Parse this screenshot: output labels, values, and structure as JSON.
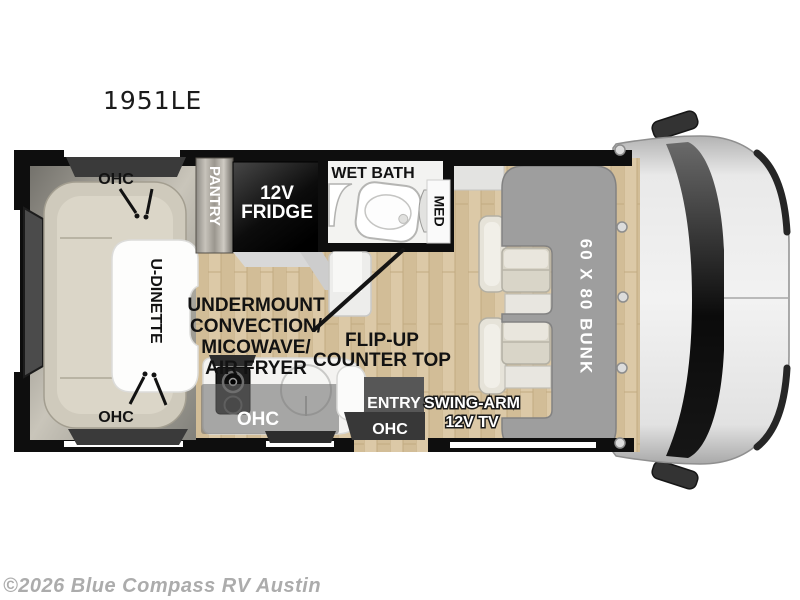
{
  "page": {
    "title": "1951LE",
    "watermark": "©2026 Blue Compass RV Austin"
  },
  "colors": {
    "wall": "#0e0e0e",
    "floor_light": "#dcc9a7",
    "floor_dark": "#d2bd97",
    "slide_gray": "#c9c5ba",
    "seat_cream": "#dbd6c8",
    "bunk_gray": "#9e9e9e",
    "cab_gray": "#ededed",
    "windshield_black": "#0b0b0b",
    "box_entry": "#575757",
    "box_ohc": "#383838",
    "label_light": "#ffffff",
    "label_dark": "#121212",
    "watermark_gray": "#acacac"
  },
  "floorplan": {
    "dinette": {
      "label": "U-DINETTE",
      "ohc_top": "OHC",
      "ohc_bottom": "OHC"
    },
    "pantry": {
      "label": "PANTRY"
    },
    "fridge": {
      "line1": "12V",
      "line2": "FRIDGE"
    },
    "wet_bath": {
      "label": "WET BATH",
      "med": "MED"
    },
    "appliance_note": {
      "line1": "UNDERMOUNT",
      "line2": "CONVECTION/",
      "line3": "MICOWAVE/",
      "line4": "AIR FRYER"
    },
    "counter_note": {
      "line1": "FLIP-UP",
      "line2": "COUNTER TOP"
    },
    "kitchen": {
      "ohc": "OHC"
    },
    "entry": {
      "label": "ENTRY",
      "ohc": "OHC"
    },
    "tv": {
      "line1": "SWING-ARM",
      "line2": "12V TV"
    },
    "bunk": {
      "label": "60 X 80 BUNK"
    }
  }
}
